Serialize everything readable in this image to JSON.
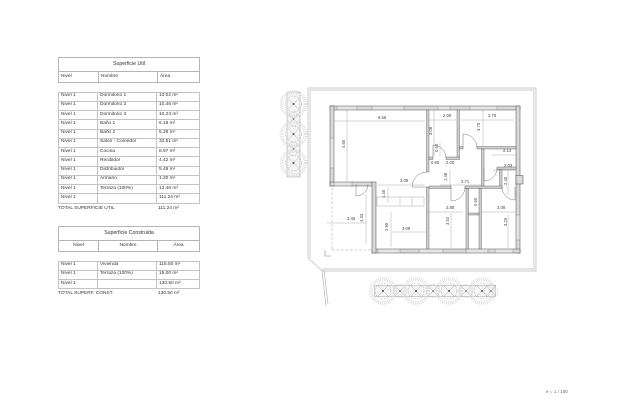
{
  "page": {
    "scale_label": "e = 1 / 100"
  },
  "tables": {
    "superficie_util": {
      "title": "Superficie Util",
      "headers": [
        "Nivel",
        "Nombre",
        "Área"
      ],
      "rows": [
        [
          "Nivel 1",
          "Dormitorio 1",
          "13.02 m²"
        ],
        [
          "Nivel 1",
          "Dormitorio 2",
          "10.46 m²"
        ],
        [
          "Nivel 1",
          "Dormitorio 3",
          "10.23 m²"
        ],
        [
          "Nivel 1",
          "Baño 1",
          "6.19 m²"
        ],
        [
          "Nivel 1",
          "Baño 2",
          "5.28 m²"
        ],
        [
          "Nivel 1",
          "Salon - Comedor",
          "32.51 m²"
        ],
        [
          "Nivel 1",
          "Cocina",
          "8.97 m²"
        ],
        [
          "Nivel 1",
          "Recibidor",
          "4.42 m²"
        ],
        [
          "Nivel 1",
          "Distribuidor",
          "5.49 m²"
        ],
        [
          "Nivel 1",
          "Armario",
          "1.20 m²"
        ],
        [
          "Nivel 1",
          "Terraza (100%)",
          "13.48 m²"
        ],
        [
          "Nivel 1",
          "",
          "111.24 m²"
        ]
      ],
      "total_label": "TOTAL SUPERFICIE UTIL",
      "total_value": "111.24 m²"
    },
    "superficie_construida": {
      "title": "Superficie Construida",
      "headers": [
        "Nivel",
        "Nombre",
        "Área"
      ],
      "rows": [
        [
          "Nivel 1",
          "Vivienda",
          "115.50 m²"
        ],
        [
          "Nivel 1",
          "Terraza (100%)",
          "15.00 m²"
        ],
        [
          "Nivel 1",
          "",
          "130.50 m²"
        ]
      ],
      "total_label": "TOTAL SUPERF. CONST.",
      "total_value": "130.50 m²"
    }
  },
  "plan": {
    "dimension_labels": [
      {
        "t": "8.56",
        "x": 378,
        "y": 119,
        "v": 0
      },
      {
        "t": "2.00",
        "x": 443,
        "y": 117,
        "v": 0
      },
      {
        "t": "3.76",
        "x": 488,
        "y": 117,
        "v": 0
      },
      {
        "t": "4.66",
        "x": 345,
        "y": 148,
        "v": 1
      },
      {
        "t": "3.08",
        "x": 432,
        "y": 135,
        "v": 1
      },
      {
        "t": "3.70",
        "x": 480,
        "y": 131,
        "v": 1
      },
      {
        "t": "2.13",
        "x": 503,
        "y": 152,
        "v": 0
      },
      {
        "t": "2.03",
        "x": 504,
        "y": 167,
        "v": 0
      },
      {
        "t": "0.60",
        "x": 438,
        "y": 152,
        "v": 1
      },
      {
        "t": "0.60",
        "x": 431,
        "y": 164,
        "v": 0
      },
      {
        "t": "2.00",
        "x": 446,
        "y": 164,
        "v": 0
      },
      {
        "t": "1.48",
        "x": 447,
        "y": 181,
        "v": 1
      },
      {
        "t": "3.71",
        "x": 461,
        "y": 183,
        "v": 0
      },
      {
        "t": "2.40",
        "x": 507,
        "y": 185,
        "v": 1
      },
      {
        "t": "3.09",
        "x": 400,
        "y": 182,
        "v": 0
      },
      {
        "t": "1.45",
        "x": 385,
        "y": 198,
        "v": 1
      },
      {
        "t": "3.46",
        "x": 347,
        "y": 220,
        "v": 0
      },
      {
        "t": "4.33",
        "x": 363,
        "y": 222,
        "v": 1
      },
      {
        "t": "2.90",
        "x": 388,
        "y": 231,
        "v": 1
      },
      {
        "t": "3.09",
        "x": 402,
        "y": 230,
        "v": 0
      },
      {
        "t": "2.88",
        "x": 446,
        "y": 209,
        "v": 0
      },
      {
        "t": "0.50",
        "x": 477,
        "y": 206,
        "v": 1
      },
      {
        "t": "3.08",
        "x": 497,
        "y": 209,
        "v": 0
      },
      {
        "t": "3.52",
        "x": 449,
        "y": 225,
        "v": 1
      },
      {
        "t": "3.26",
        "x": 507,
        "y": 226,
        "v": 1
      }
    ]
  }
}
